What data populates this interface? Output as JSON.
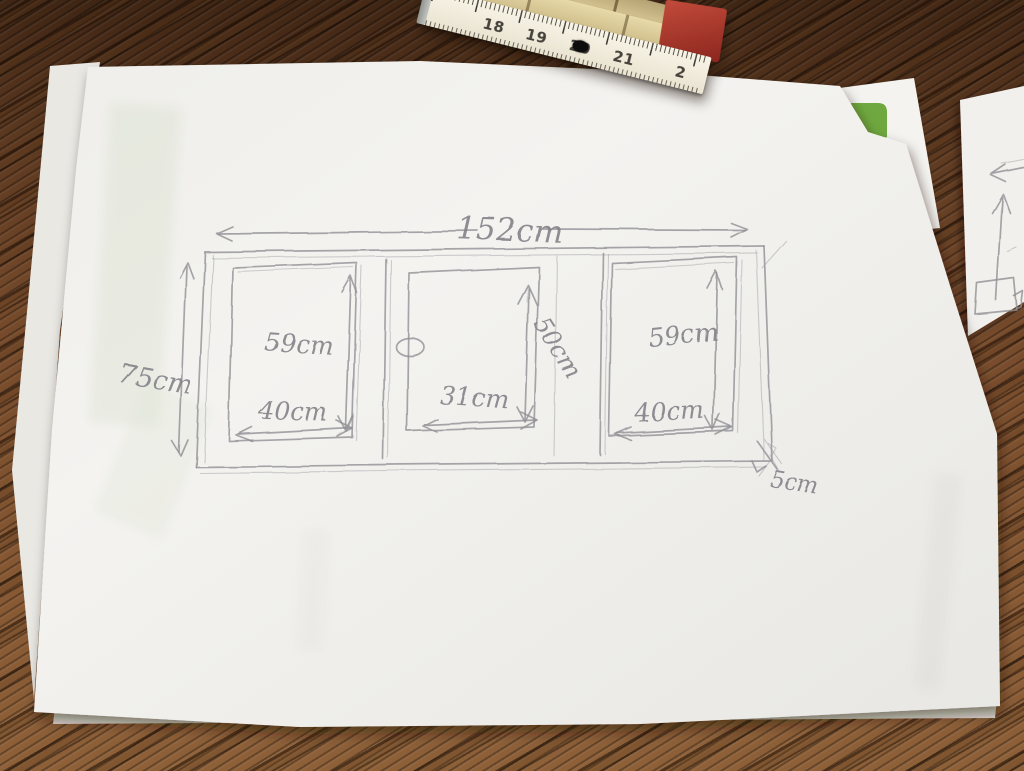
{
  "sketch": {
    "total_width_label": "152cm",
    "total_height_label": "75cm",
    "gap_label": "5cm",
    "panels": [
      {
        "height_label": "59cm",
        "width_label": "40cm"
      },
      {
        "height_label": "50cm",
        "width_label": "31cm"
      },
      {
        "height_label": "59cm",
        "width_label": "40cm"
      }
    ]
  },
  "ruler": {
    "numbers": [
      "18",
      "19",
      "20",
      "21",
      "2"
    ],
    "red_number": "20"
  },
  "colors": {
    "pencil_text": "#7f7f86",
    "pencil_stroke": "#8e8e94",
    "paper": "#f2f1ee",
    "wood_brown": "#74492a",
    "logo_green": "#6fa83f",
    "ruler_red": "#a93c30",
    "ruler_red_digit": "#c5453c"
  }
}
